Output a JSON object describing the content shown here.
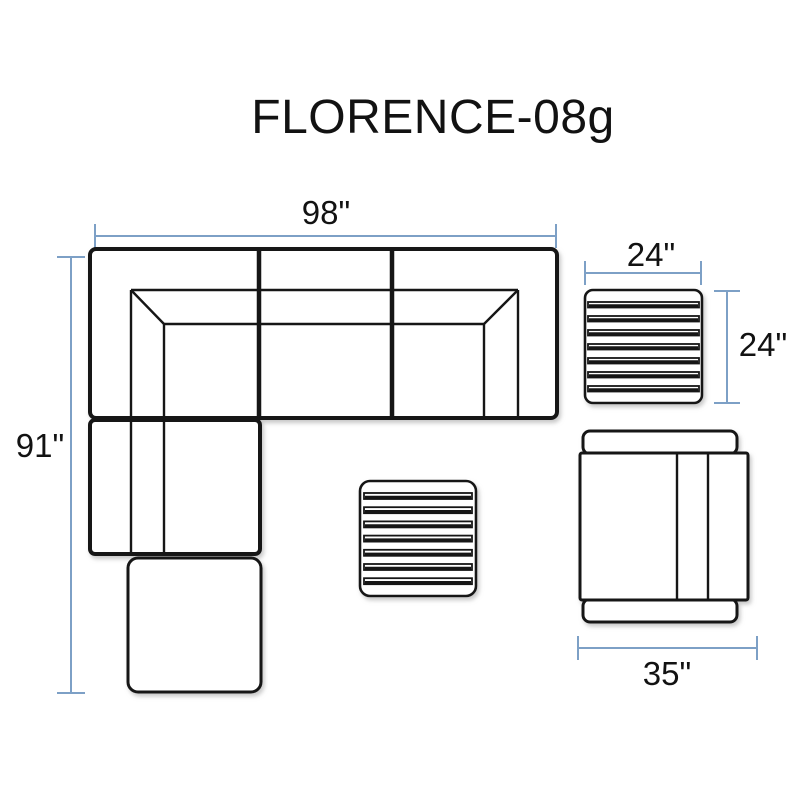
{
  "title": "FLORENCE-08g",
  "colors": {
    "background": "#ffffff",
    "line": "#161616",
    "dimension_line": "#7da0c6",
    "label_text": "#121212"
  },
  "diagram": {
    "labels": {
      "sectional_width": "98\"",
      "sectional_depth": "91\"",
      "side_table_width": "24\"",
      "side_table_depth": "24\"",
      "club_chair_width": "35\""
    },
    "slat_count": 7,
    "pieces": [
      "corner-sectional-sofa",
      "chaise-section",
      "ottoman",
      "coffee-table",
      "side-table",
      "club-chair"
    ]
  }
}
